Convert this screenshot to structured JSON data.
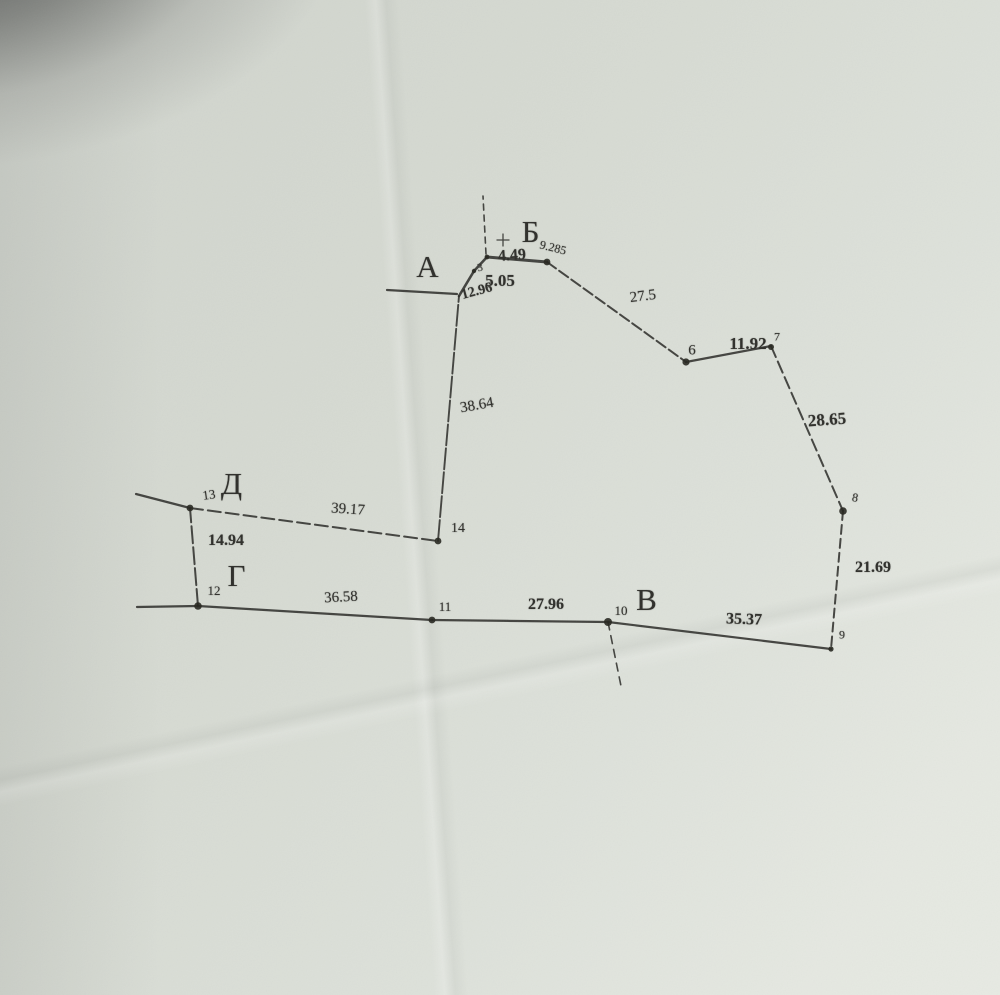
{
  "plan": {
    "letters": {
      "a": "А",
      "b": "Б",
      "v": "В",
      "g": "Г",
      "d": "Д"
    },
    "points": {
      "p3": "3",
      "p6": "6",
      "p7": "7",
      "p8": "8",
      "p9": "9",
      "p10": "10",
      "p11": "11",
      "p12": "12",
      "p13": "13",
      "p14": "14"
    },
    "distances": {
      "near_b": "9.285",
      "p4_p5": "4.49",
      "p3_p4": "5.05",
      "p2_p3": "12.96",
      "p5_p6": "27.5",
      "p6_p7": "11.92",
      "p7_p8": "28.65",
      "p8_p9": "21.69",
      "p9_p10": "35.37",
      "p10_p11": "27.96",
      "p11_p12": "36.58",
      "p12_p13": "14.94",
      "p13_p14": "39.17",
      "p14_p2": "38.64"
    }
  }
}
